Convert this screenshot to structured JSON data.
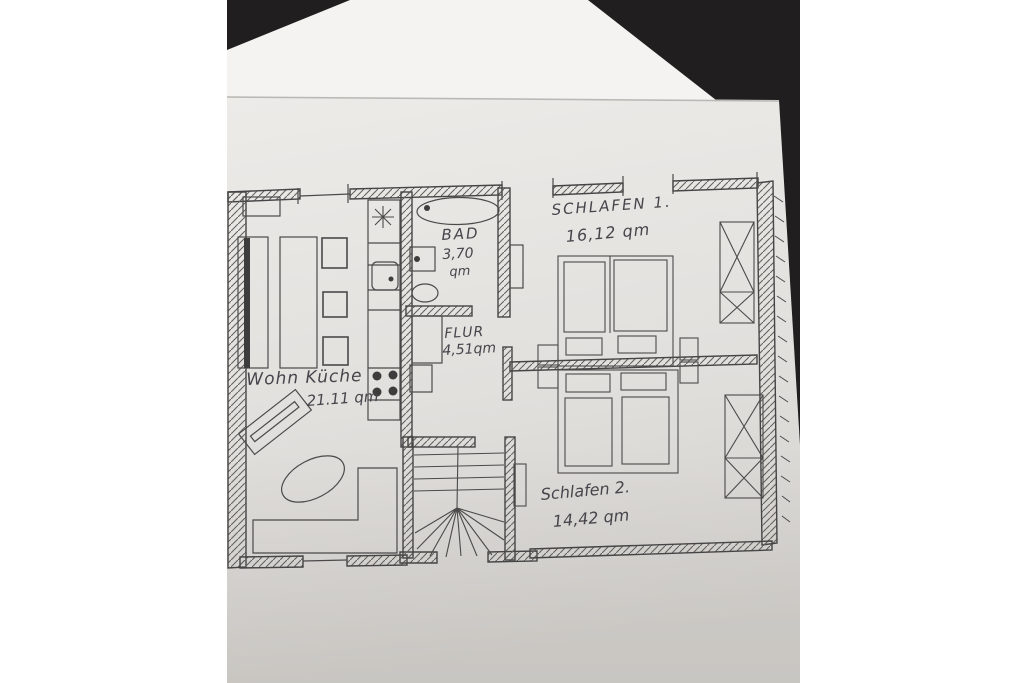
{
  "photo": {
    "background_color": "#201e1f",
    "back_sheet_color": "#f4f3f1",
    "paper_color_top": "#edebe8",
    "paper_color_bottom": "#d2d0cc",
    "pencil_color": "#4a4a4a"
  },
  "floor_plan": {
    "rooms": [
      {
        "id": "wohnkueche",
        "name": "Wohn Küche",
        "area": "21.11 qm"
      },
      {
        "id": "bad",
        "name": "BAD",
        "area": "3,70",
        "area_unit": "qm"
      },
      {
        "id": "flur",
        "name": "FLUR",
        "area": "4,51qm"
      },
      {
        "id": "schlafen1",
        "name": "SCHLAFEN 1.",
        "area": "16,12 qm"
      },
      {
        "id": "schlafen2",
        "name": "Schlafen 2.",
        "area": "14,42 qm"
      }
    ]
  }
}
